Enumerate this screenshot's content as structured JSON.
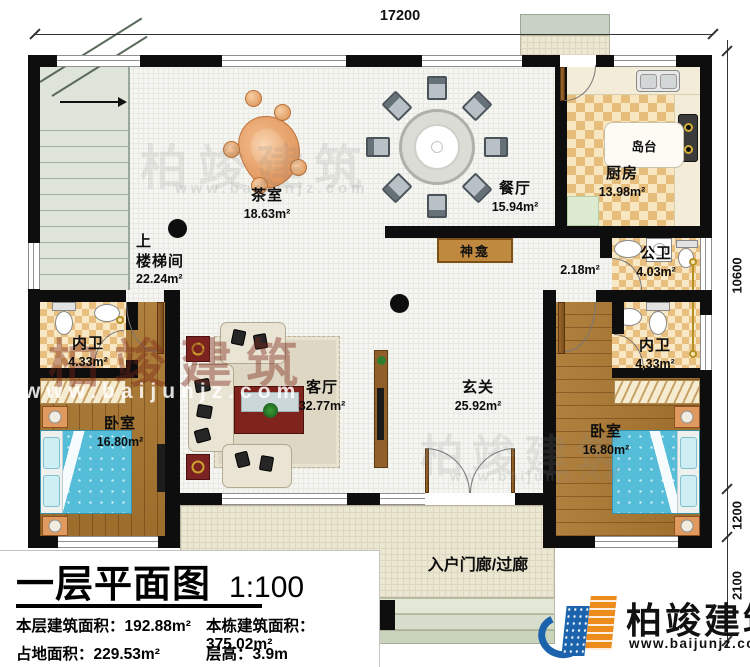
{
  "plan": {
    "dims": {
      "top": "17200",
      "right_upper": "10600",
      "right_mid": "1200",
      "right_lower": "2100"
    },
    "rooms": {
      "stairwell": {
        "up": "上",
        "name": "楼梯间",
        "area": "22.24m²"
      },
      "tea_room": {
        "name": "茶室",
        "area": "18.63m²"
      },
      "dining": {
        "name": "餐厅",
        "area": "15.94m²"
      },
      "kitchen": {
        "name": "厨房",
        "area": "13.98m²"
      },
      "island": {
        "name": "岛台"
      },
      "shrine": {
        "name": "神龛"
      },
      "vestibule": {
        "area": "2.18m²"
      },
      "public_bath": {
        "name": "公卫",
        "area": "4.03m²"
      },
      "left_bath": {
        "name": "内卫",
        "area": "4.33m²"
      },
      "right_bath": {
        "name": "内卫",
        "area": "4.33m²"
      },
      "left_bedroom": {
        "name": "卧室",
        "area": "16.80m²"
      },
      "right_bedroom": {
        "name": "卧室",
        "area": "16.80m²"
      },
      "living": {
        "name": "客厅",
        "area": "32.77m²"
      },
      "foyer": {
        "name": "玄关",
        "area": "25.92m²"
      },
      "porch": {
        "name": "入户门廊/过廊"
      }
    }
  },
  "title_block": {
    "title": "一层平面图",
    "scale": "1:100",
    "stats": {
      "floor_area_label": "本层建筑面积：",
      "floor_area_value": "192.88m²",
      "building_area_label": "本栋建筑面积：",
      "building_area_value": "375.02m²",
      "land_area_label": "占地面积：",
      "land_area_value": "229.53m²",
      "height_label": "层高：",
      "height_value": "3.9m"
    }
  },
  "branding": {
    "name": "柏竣建筑",
    "website": "www.baijunjz.com"
  },
  "watermark": {
    "brand": "柏竣建筑",
    "site": "www.baijunjz.com"
  }
}
